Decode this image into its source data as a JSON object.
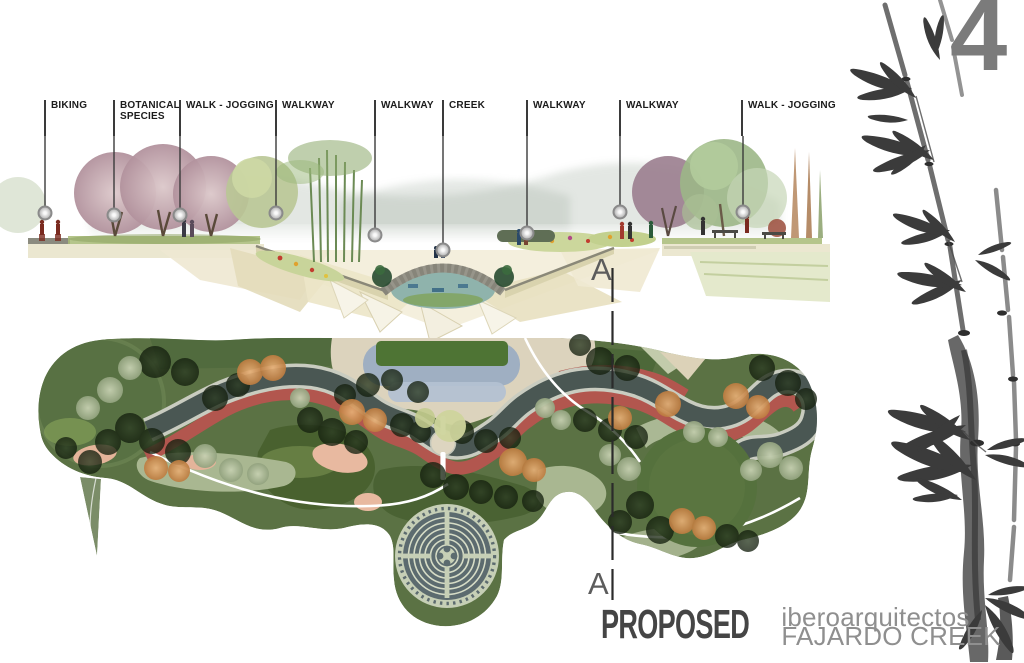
{
  "page_number": "4",
  "section": {
    "labels": [
      "BIKING",
      "BOTANICAL SPECIES",
      "WALK - JOGGING",
      "WALKWAY",
      "WALKWAY",
      "CREEK",
      "WALKWAY",
      "WALKWAY",
      "WALK - JOGGING"
    ]
  },
  "section_cut": {
    "top_label": "A",
    "bottom_label": "A"
  },
  "title_block": {
    "status": "PROPOSED",
    "firm": "iberoarquitectos",
    "project": "FAJARDO CREEK"
  },
  "colors": {
    "page_number_gray": "#7b7b7b",
    "title_dark": "#454545",
    "title_gray": "#8f8f8f",
    "label_text": "#1c1c1c",
    "plan_green": "#5b7244",
    "creek_slate": "#4a5753",
    "jogging_red": "#b2564e",
    "plaza_beige": "#dcd3bd",
    "track_bluegray": "#9fafc2",
    "labyrinth_ring": "#c6cfb6"
  }
}
